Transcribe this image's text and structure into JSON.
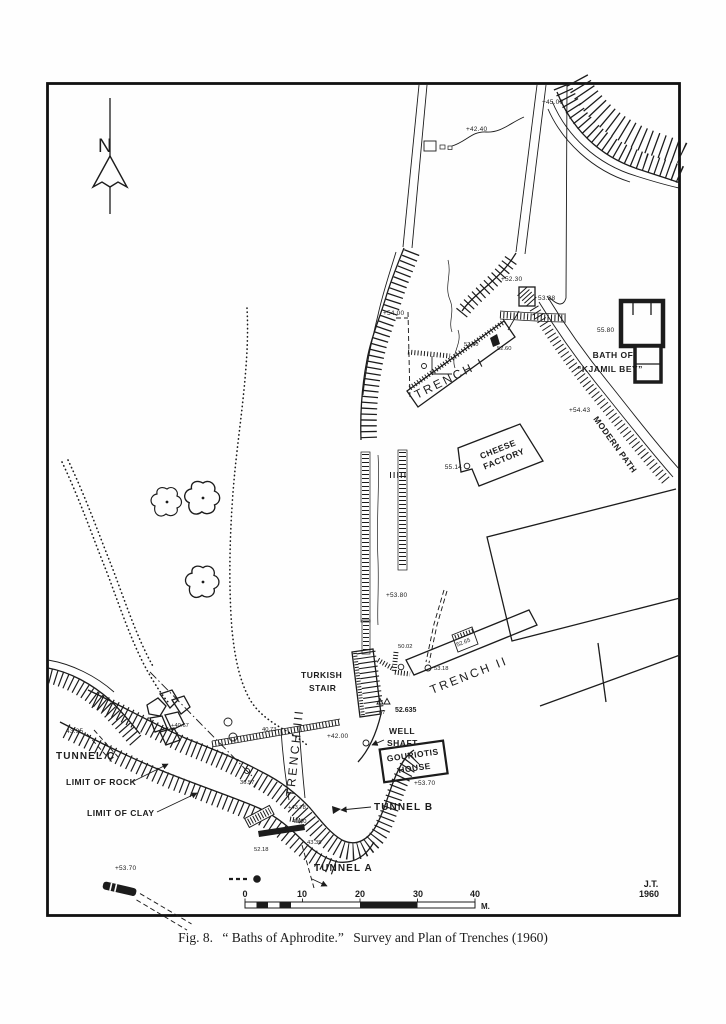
{
  "figure": {
    "caption_prefix": "Fig. 8.",
    "caption_title": "“ Baths of Aphrodite.”",
    "caption_rest": "Survey and Plan of Trenches (1960)",
    "signature_line1": "J.T.",
    "signature_line2": "1960"
  },
  "compass": {
    "north": "N"
  },
  "scalebar": {
    "ticks": [
      "0",
      "10",
      "20",
      "30",
      "40"
    ],
    "unit": "M."
  },
  "labels": {
    "trench_i": "TRENCH I",
    "trench_ii": "TRENCH II",
    "trench_iii": "TRENCH III",
    "turkish_stair_line1": "TURKISH",
    "turkish_stair_line2": "STAIR",
    "well_shaft_line1": "WELL",
    "well_shaft_line2": "SHAFT",
    "gouriotis_house_line1": "GOURIOTIS",
    "gouriotis_house_line2": "HOUSE",
    "cheese_factory_line1": "CHEESE",
    "cheese_factory_line2": "FACTORY",
    "bath_line1": "BATH OF",
    "bath_line2": "“KJAMIL BEY”",
    "modern_path": "MODERN PATH",
    "tunnel_a": "TUNNEL A",
    "tunnel_b": "TUNNEL B",
    "tunnel_c": "TUNNEL C",
    "limit_of_rock": "LIMIT OF ROCK",
    "limit_of_clay": "LIMIT OF CLAY"
  },
  "elevations": {
    "e45_00": "+45.00",
    "e42_40": "+42.40",
    "e52_30": "+52.30",
    "e53_28": "53.28",
    "e54_00": "+54.00",
    "e52_00": "52.00",
    "e52_60": "52.60",
    "e55_80": "55.80",
    "e54_43": "+54.43",
    "e55_14": "55.14",
    "e53_80": "+53.80",
    "e50_02": "50.02",
    "e52_65": "52.65",
    "e53_18": "53.18",
    "benchmark_value": "52.635",
    "benchmark_station": "67",
    "e42_00": "+42.00",
    "e43_95": "43.95",
    "e40_67": "+40.67",
    "e40_73": "40.73",
    "e36_57": "36.57",
    "e53_70_east": "+53.70",
    "e43_78": "+43.78",
    "e49_00": "49.00",
    "e43_35": "43.35",
    "e52_18": "52.18",
    "e53_70_west": "+53.70"
  },
  "ink_color": "#1c1c1c",
  "paper_color": "#fefefe"
}
